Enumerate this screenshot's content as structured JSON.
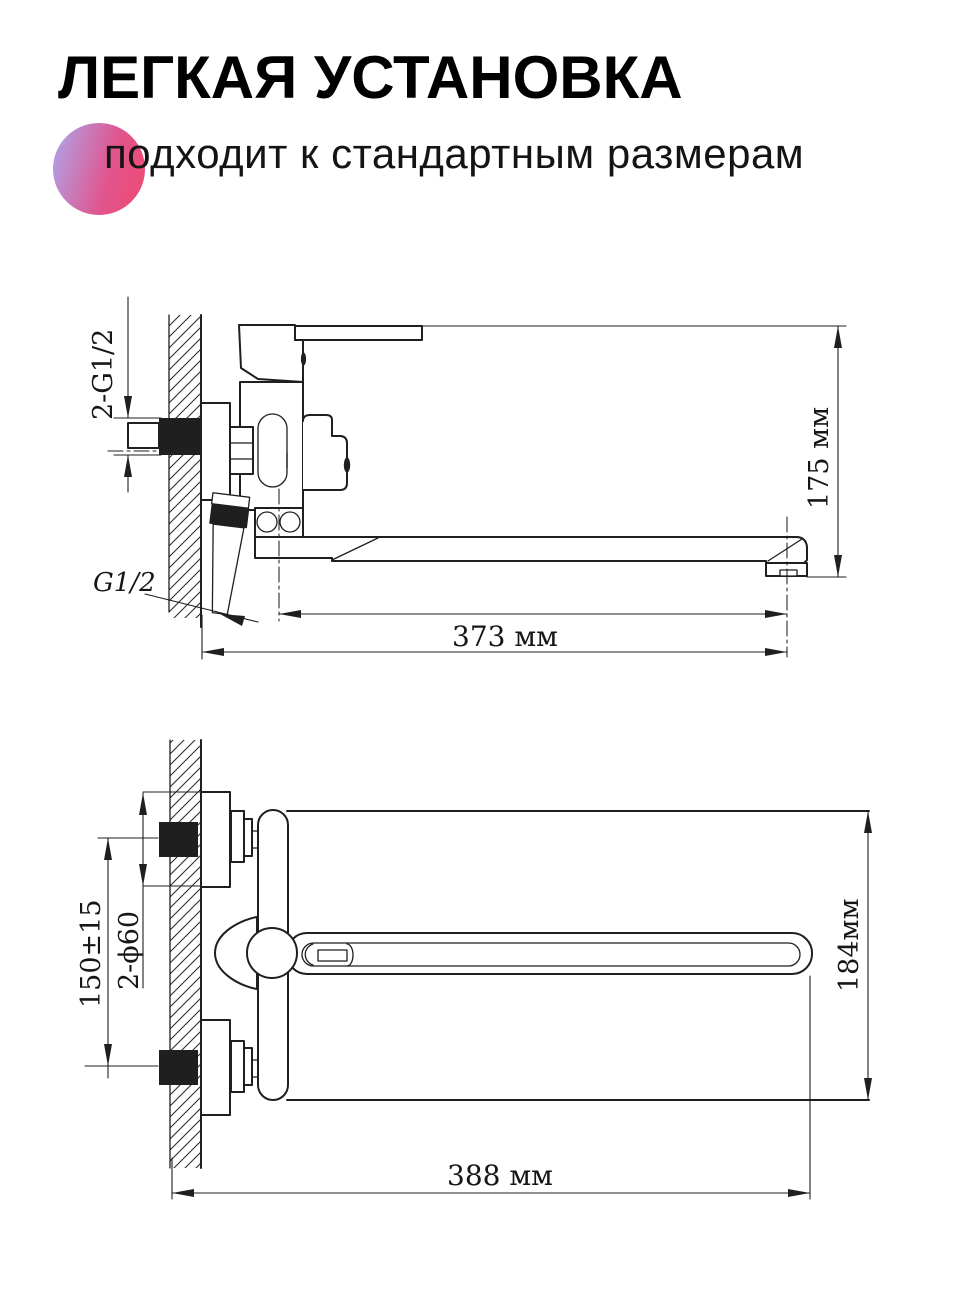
{
  "header": {
    "title": "ЛЕГКАЯ УСТАНОВКА",
    "subtitle": "подходит к стандартным размерам",
    "accent": {
      "gradient_start": "#b2a0e4",
      "gradient_mid": "#e1548d",
      "gradient_end": "#ee4b74"
    }
  },
  "drawings": {
    "line_color": "#1f1f1f",
    "side_view": {
      "labels": {
        "inlet_thread": "2-G1/2",
        "hose_thread": "G1/2",
        "spout_reach": "373 мм",
        "height": "175 мм"
      }
    },
    "plan_view": {
      "labels": {
        "inlet_spacing": "150±15",
        "escutcheon": "2-ϕ60",
        "depth": "184мм",
        "overall_length": "388 мм"
      }
    }
  }
}
